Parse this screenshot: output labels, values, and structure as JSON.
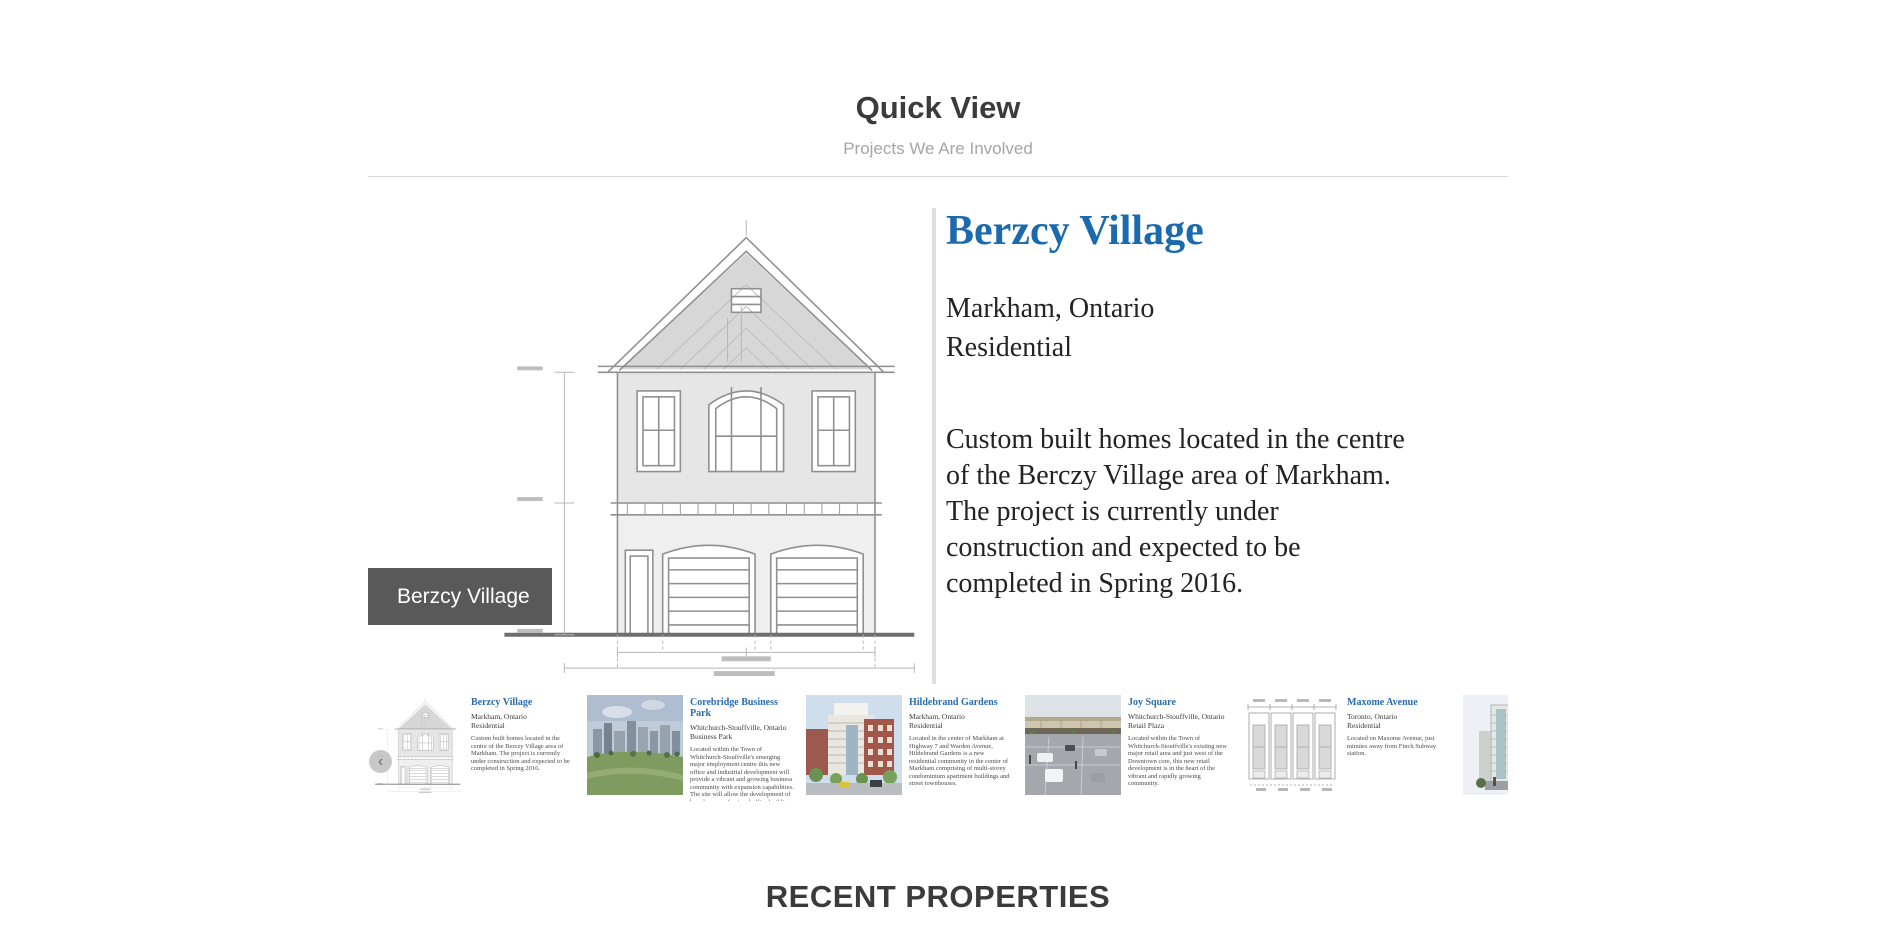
{
  "header": {
    "title": "Quick View",
    "subtitle": "Projects We Are Involved"
  },
  "featured": {
    "badge_label": "Berzcy Village",
    "title": "Berzcy Village",
    "location": "Markham, Ontario",
    "type": "Residential",
    "description": "Custom built homes located in the centre of the Berczy Village area of Markham. The project is currently under construction and expected to be completed in Spring 2016.",
    "image": "house-blueprint-elevation",
    "title_color": "#1a6aad",
    "badge_bg_color": "#595959"
  },
  "carousel": {
    "prev_icon": "chevron-left",
    "prev_glyph": "‹",
    "card_title_color": "#2a6cb0",
    "cards": [
      {
        "title": "Berzcy Village",
        "location": "Markham, Ontario",
        "type": "Residential",
        "description": "Custom built homes located in the centre of the Berczy Village area of Markham. The project is currently under construction and expected to be completed in Spring 2016.",
        "image": "house-blueprint-thumbnail"
      },
      {
        "title": "Corebridge Business Park",
        "location": "Whitchurch-Stouffville, Ontario",
        "type": "Business Park",
        "description": "Located within the Town of Whitchurch-Stouffville's emerging major employment centre this new office and industrial development will provide a vibrant and growing business community with expansion capabilities. The site will allow the development of brand new professional office buildings and state of the art industrial facilities for tenants or for owner/users.",
        "image": "business-park-rendering"
      },
      {
        "title": "Hildebrand Gardens",
        "location": "Markham, Ontario",
        "type": "Residential",
        "description": "Located in the center of Markham at Highway 7 and Warden Avenue, Hildebrand Gardens is a new residential community in the center of Markham comprising of multi-storey condominium apartment buildings and street townhouses.",
        "image": "midrise-building-rendering"
      },
      {
        "title": "Joy Square",
        "location": "Whitchurch-Stouffville, Ontario",
        "type": "Retail Plaza",
        "description": "Located within the Town of Whitchurch-Stouffville's existing new major retail area and just west of the Downtown core, this new retail development is in the heart of the vibrant and rapidly growing community.",
        "image": "retail-plaza-rendering"
      },
      {
        "title": "Maxome Avenue",
        "location": "Toronto, Ontario",
        "type": "Residential",
        "description": "Located on Maxome Avenue, just minutes away from Finch Subway station.",
        "image": "townhouse-blueprint-thumbnail"
      },
      {
        "image": "condo-tower-rendering"
      }
    ]
  },
  "footer": {
    "heading": "RECENT PROPERTIES"
  }
}
